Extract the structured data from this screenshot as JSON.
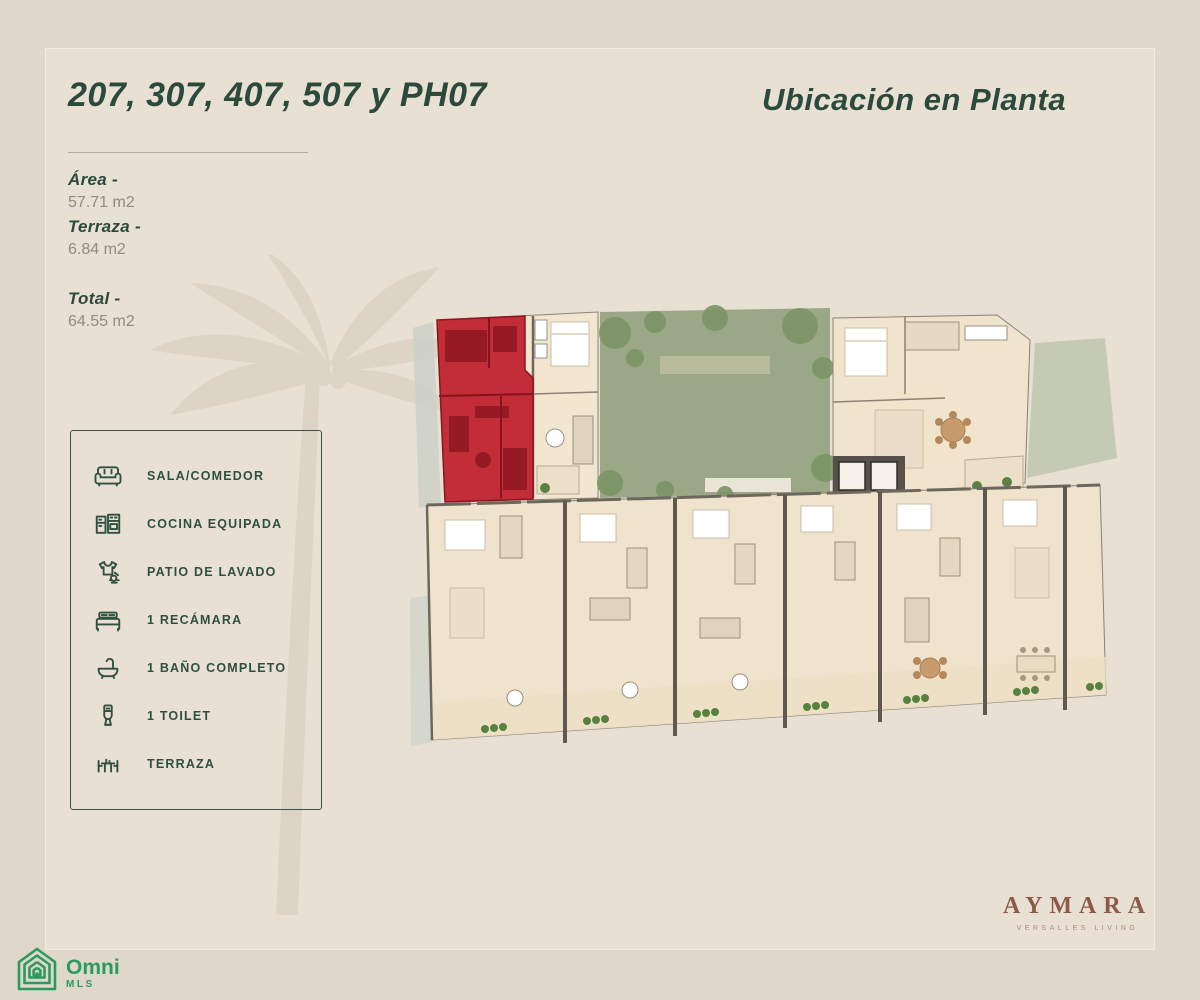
{
  "colors": {
    "background": "#ded7ca",
    "frame_background": "#e7e0d3",
    "accent_green": "#2c4a3b",
    "muted_gray": "#8f8c82",
    "highlight_red": "#c0232f",
    "courtyard_green": "#9aa887",
    "logo_brown": "#8d5a49",
    "mls_green": "#2c9a5f"
  },
  "header": {
    "units_title": "207, 307, 407, 507 y PH07",
    "location_title": "Ubicación en Planta"
  },
  "measurements": {
    "area_label": "Área -",
    "area_value": "57.71 m2",
    "terrace_label": "Terraza -",
    "terrace_value": "6.84 m2",
    "total_label": "Total -",
    "total_value": "64.55 m2"
  },
  "legend": {
    "items": [
      {
        "icon": "sofa-icon",
        "label": "SALA/COMEDOR"
      },
      {
        "icon": "kitchen-icon",
        "label": "COCINA EQUIPADA"
      },
      {
        "icon": "laundry-icon",
        "label": "PATIO DE LAVADO"
      },
      {
        "icon": "bed-icon",
        "label": "1 RECÁMARA"
      },
      {
        "icon": "bath-icon",
        "label": "1 BAÑO COMPLETO"
      },
      {
        "icon": "toilet-icon",
        "label": "1 TOILET"
      },
      {
        "icon": "terrace-icon",
        "label": "TERRAZA"
      }
    ]
  },
  "branding": {
    "project_name": "AYMARA",
    "project_tagline": "VERSALLES LIVING",
    "mls_logo_text": "Omni",
    "mls_logo_subtext": "MLS"
  }
}
